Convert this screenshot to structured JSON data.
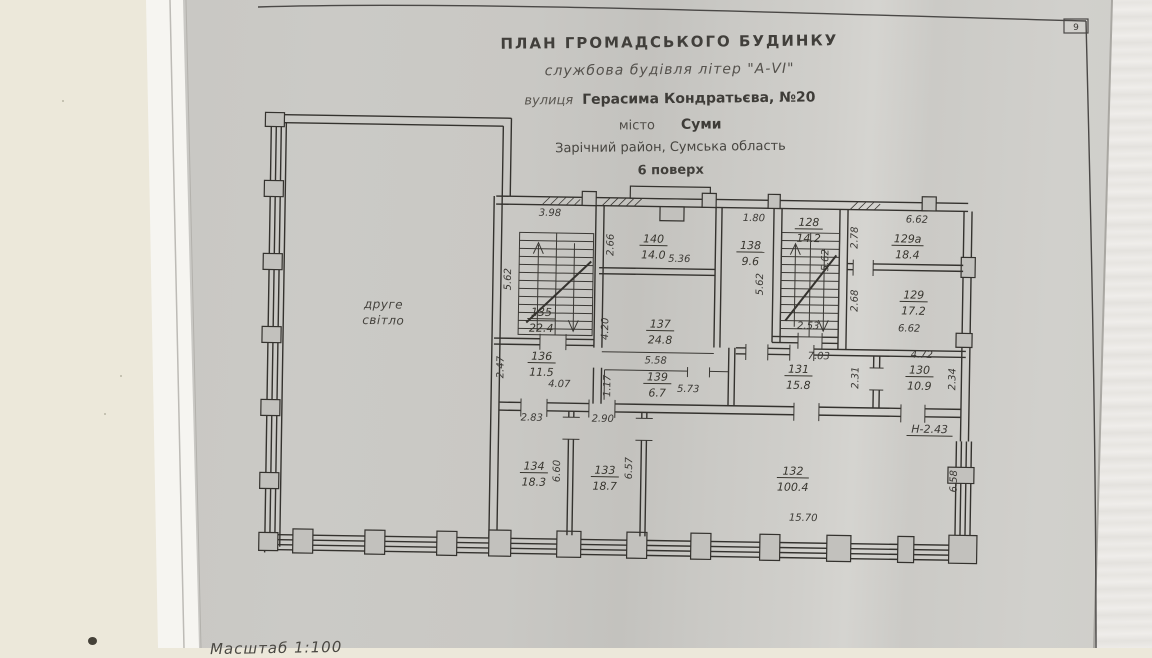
{
  "page": {
    "number": "9"
  },
  "title": {
    "line1": "ПЛАН  ГРОМАДСЬКОГО  БУДИНКУ",
    "line2": "службова будівля літер \"А-VI\"",
    "line3_label": "вулиця",
    "line3_value": "Герасима Кондратьєва, №20",
    "line4_label": "місто",
    "line4_value": "Суми",
    "line5": "Зарічний район, Сумська область",
    "line6": "6 поверх"
  },
  "plan": {
    "open_space": {
      "line1": "друге",
      "line2": "світло"
    },
    "rooms": [
      {
        "number": "135",
        "area": "22.4"
      },
      {
        "number": "140",
        "area": "14.0"
      },
      {
        "number": "138",
        "area": "9.6"
      },
      {
        "number": "128",
        "area": "14.2"
      },
      {
        "number": "129а",
        "area": "18.4"
      },
      {
        "number": "129",
        "area": "17.2"
      },
      {
        "number": "137",
        "area": "24.8"
      },
      {
        "number": "136",
        "area": "11.5"
      },
      {
        "number": "139",
        "area": "6.7"
      },
      {
        "number": "131",
        "area": "15.8"
      },
      {
        "number": "130",
        "area": "10.9"
      },
      {
        "number": "134",
        "area": "18.3"
      },
      {
        "number": "133",
        "area": "18.7"
      },
      {
        "number": "132",
        "area": "100.4"
      }
    ],
    "dimensions": [
      "3.98",
      "5.62",
      "2.66",
      "5.36",
      "1.80",
      "5.62",
      "5.62",
      "2.53",
      "2.78",
      "6.62",
      "2.68",
      "6.62",
      "4.20",
      "5.58",
      "2.47",
      "4.07",
      "1.17",
      "5.73",
      "7.03",
      "2.31",
      "4.72",
      "2.34",
      "2.83",
      "2.90",
      "6.60",
      "6.57",
      "15.70",
      "6.58"
    ],
    "height_note": "Н-2.43"
  },
  "footer": {
    "scale": "Масштаб  1:100"
  }
}
